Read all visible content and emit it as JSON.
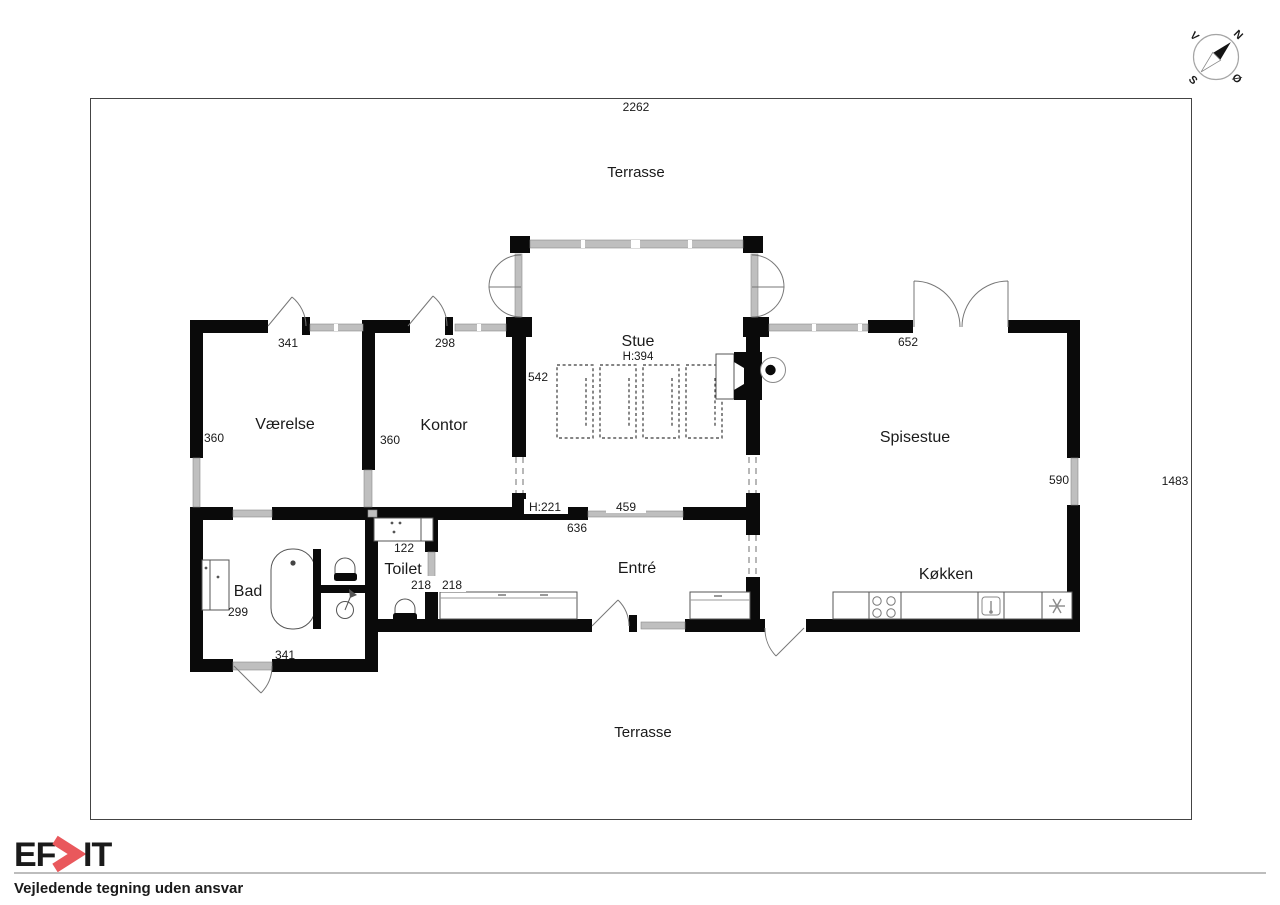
{
  "plan": {
    "dim_top": "2262",
    "dim_right": "1483",
    "terrace_top": "Terrasse",
    "terrace_bottom": "Terrasse",
    "rooms": {
      "stue": "Stue",
      "stue_height": "H:394",
      "vaerelse": "Værelse",
      "kontor": "Kontor",
      "spisestue": "Spisestue",
      "koekken": "Køkken",
      "entre": "Entré",
      "toilet": "Toilet",
      "bad": "Bad"
    },
    "dims": {
      "vaerelse_width": "341",
      "kontor_width": "298",
      "spisestue_width": "652",
      "stue_depth": "542",
      "vaerelse_depth": "360",
      "kontor_depth": "360",
      "koekken_right": "590",
      "toilet_width": "122",
      "toilet_door_a": "218",
      "toilet_door_b": "218",
      "bad_depth": "299",
      "bad_width": "341",
      "entre_ceiling": "H:221",
      "entre_wall": "636",
      "stue_window": "459"
    }
  },
  "compass": {
    "north": "N",
    "south": "S",
    "west": "V",
    "east": "Ø"
  },
  "footer": {
    "logo_ef": "EF",
    "logo_it": "IT",
    "logo_navy": "#2f3a5c",
    "logo_red": "#e9585c",
    "disclaimer": "Vejledende tegning uden ansvar"
  }
}
